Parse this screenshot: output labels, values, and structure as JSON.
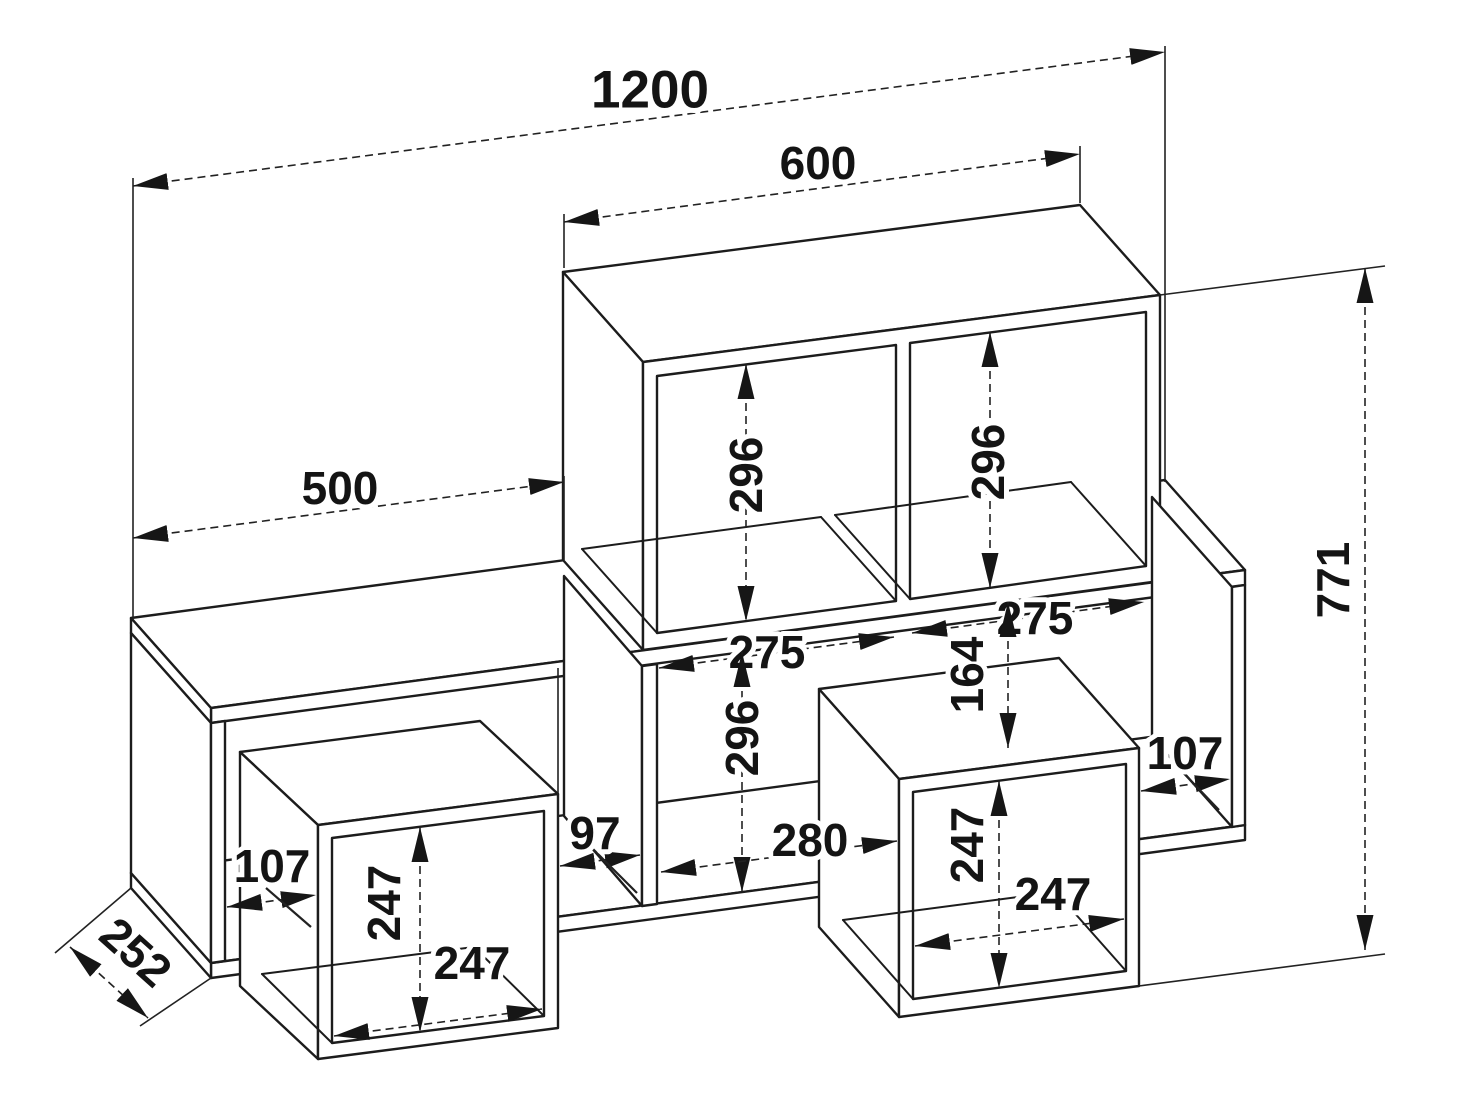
{
  "drawing": {
    "kind": "furniture wall-shelf dimensioned technical drawing",
    "colors": {
      "background": "#ffffff",
      "lines": "#1c1c1c",
      "text": "#141414"
    }
  },
  "labels": {
    "d1200": "1200",
    "d600": "600",
    "d500": "500",
    "d771": "771",
    "d252": "252",
    "d296_top_left": "296",
    "d296_top_right": "296",
    "d296_middle": "296",
    "d275_left": "275",
    "d275_right": "275",
    "d280": "280",
    "d164": "164",
    "d97": "97",
    "d107_left": "107",
    "d107_right": "107",
    "d247_left_v": "247",
    "d247_left_h": "247",
    "d247_right_v": "247",
    "d247_right_h": "247"
  }
}
